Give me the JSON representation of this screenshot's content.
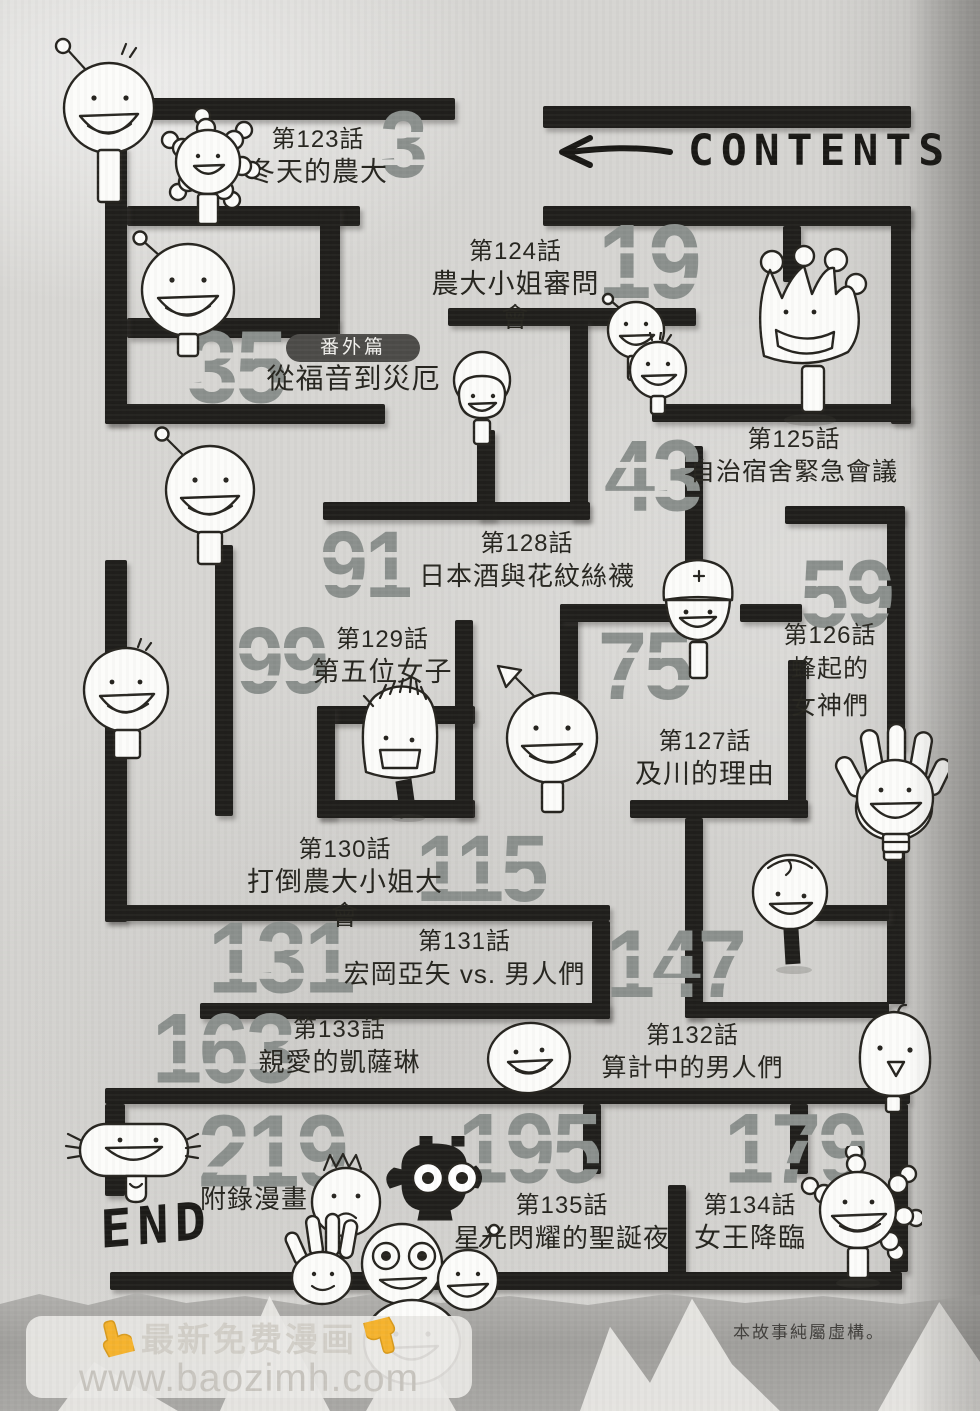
{
  "header": {
    "title": "CONTENTS"
  },
  "entries": [
    {
      "chapter": "第123話",
      "title": "冬天的農大",
      "page": "3"
    },
    {
      "chapter": "第124話",
      "title": "農大小姐審問會",
      "page": "19"
    },
    {
      "badge": "番外篇",
      "title": "從福音到災厄",
      "page": "35"
    },
    {
      "chapter": "第125話",
      "title": "自治宿舍緊急會議",
      "page": "43"
    },
    {
      "chapter": "第128話",
      "title": "日本酒與花紋絲襪",
      "page": "91"
    },
    {
      "chapter": "第126話",
      "title_lines": [
        "蜂起的",
        "女神們"
      ],
      "page": "59"
    },
    {
      "chapter": "第129話",
      "title": "第五位女子",
      "page": "99"
    },
    {
      "chapter": "第127話",
      "title": "及川的理由",
      "page": "75"
    },
    {
      "chapter": "第130話",
      "title": "打倒農大小姐大會",
      "page": "115"
    },
    {
      "chapter": "第131話",
      "title": "宏岡亞矢 vs. 男人們",
      "page": "131"
    },
    {
      "chapter": "第132話",
      "title": "算計中的男人們",
      "page": "147"
    },
    {
      "chapter": "第133話",
      "title": "親愛的凱薩琳",
      "page": "163"
    },
    {
      "chapter": "第134話",
      "title": "女王降臨",
      "page": "179"
    },
    {
      "chapter": "第135話",
      "title": "星光閃耀的聖誕夜",
      "page": "195"
    },
    {
      "title": "附錄漫畫",
      "page": "219"
    }
  ],
  "end_label": "END",
  "disclaimer": "本故事純屬虛構。",
  "watermark": {
    "line1": "最新免费漫画",
    "line2": "www.baozimh.com"
  },
  "colors": {
    "page_number": "#8b908d",
    "wall": "#201f1c",
    "badge_bg": "#4c4b48",
    "hand": "#f5b32e"
  }
}
